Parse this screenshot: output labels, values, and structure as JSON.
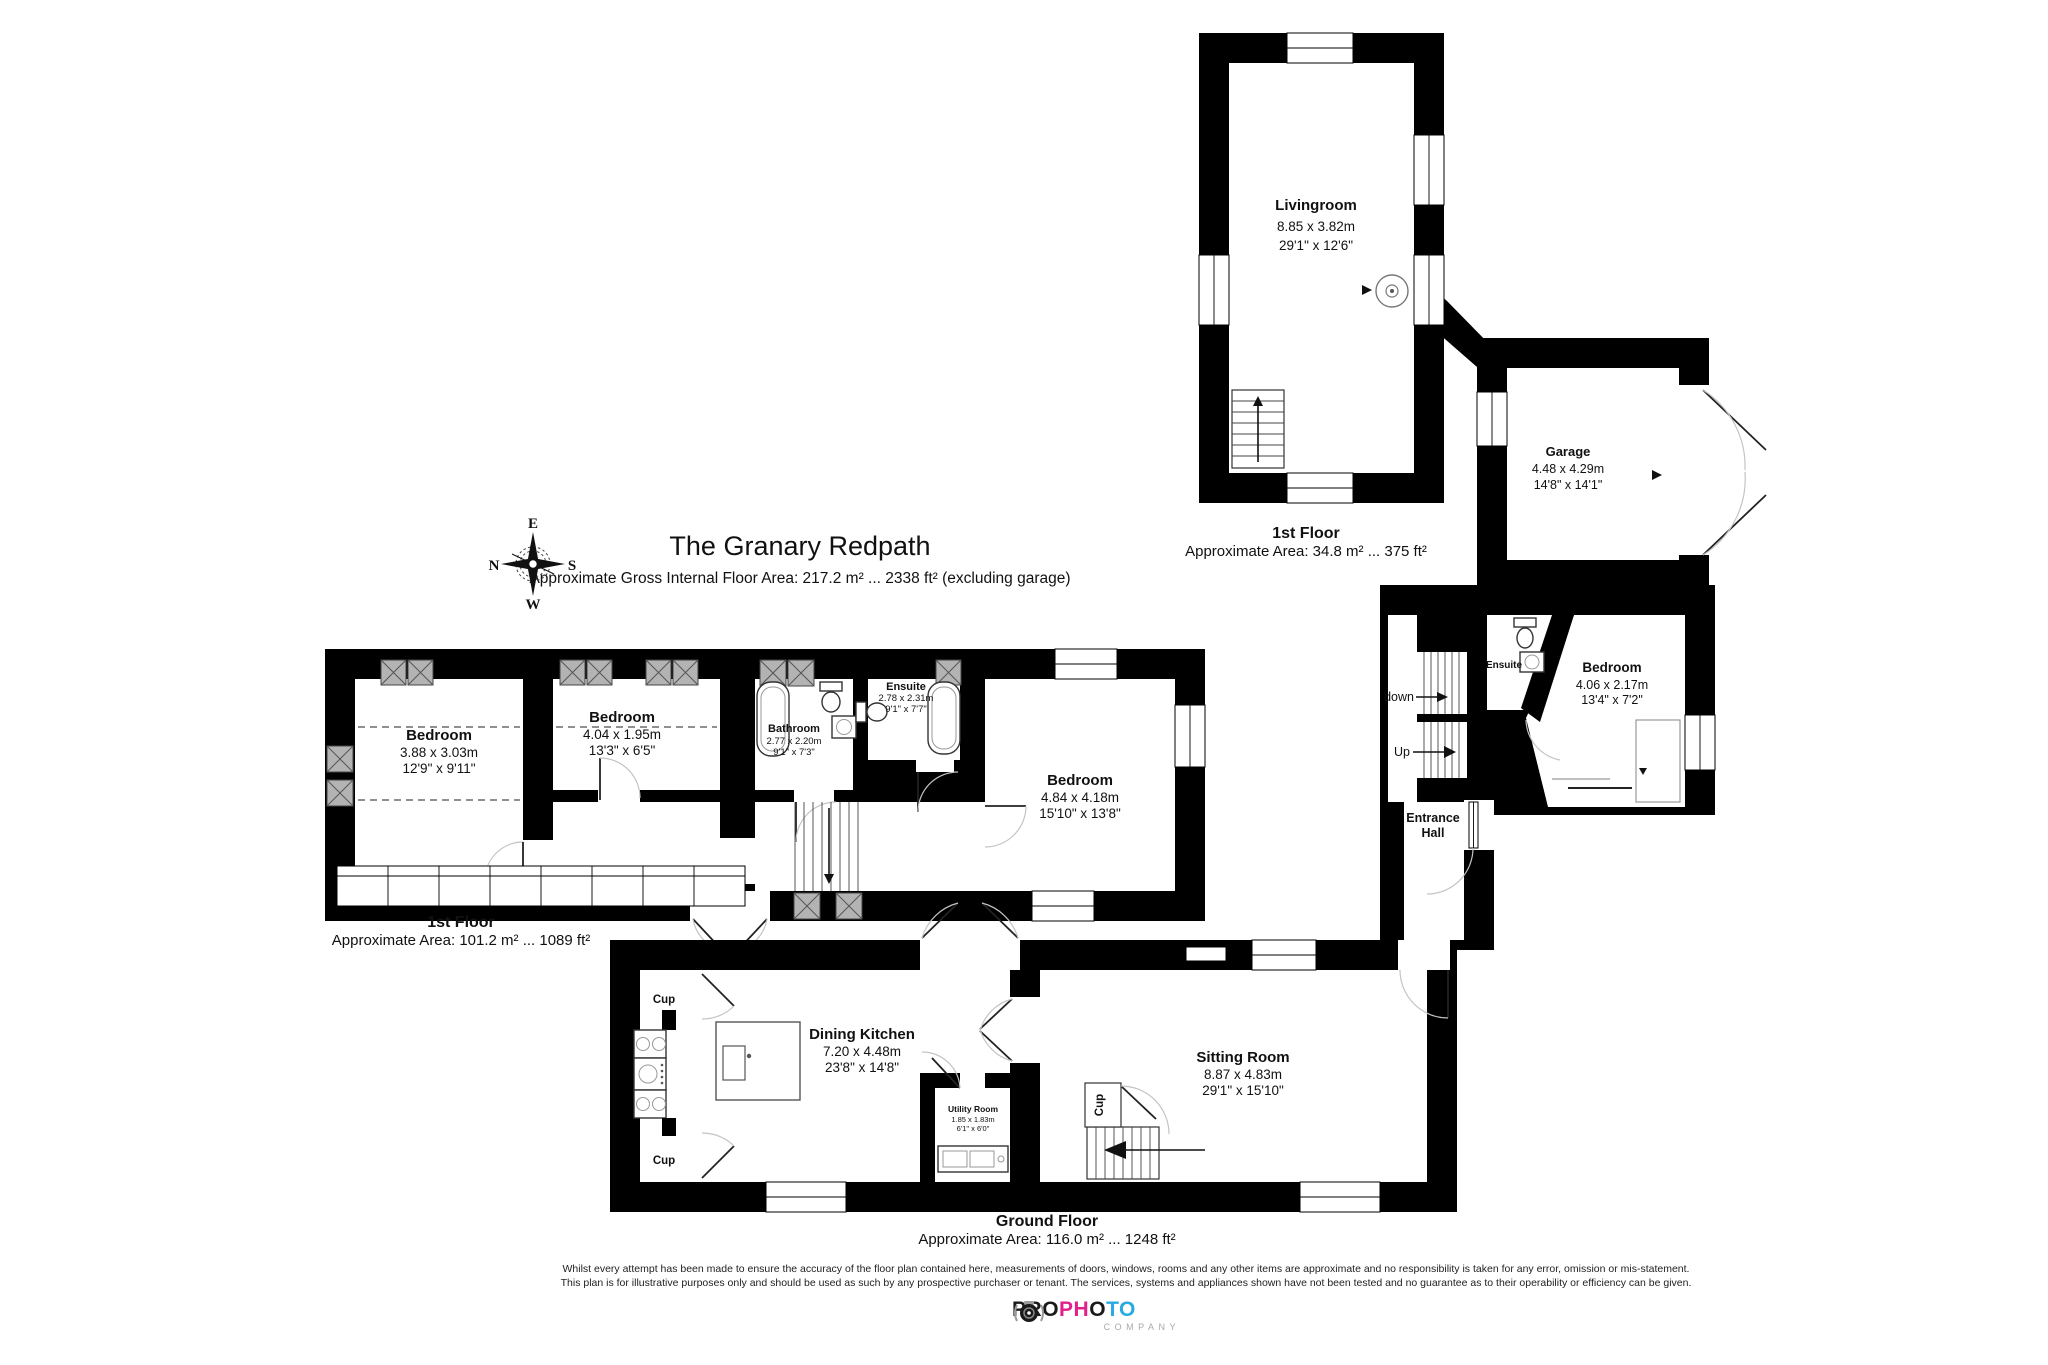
{
  "page": {
    "title": "The Granary Redpath",
    "subtitle": "Approximate Gross Internal Floor Area: 217.2 m² ... 2338 ft² (excluding garage)"
  },
  "compass": {
    "top": "E",
    "left": "N",
    "right": "S",
    "bottom": "W"
  },
  "floor_labels": {
    "annex_first": {
      "name": "1st Floor",
      "area": "Approximate Area: 34.8 m² ... 375 ft²"
    },
    "main_first": {
      "name": "1st Floor",
      "area": "Approximate Area: 101.2 m² ... 1089 ft²"
    },
    "ground": {
      "name": "Ground Floor",
      "area": "Approximate Area: 116.0 m² ... 1248 ft²"
    }
  },
  "rooms": {
    "livingroom": {
      "name": "Livingroom",
      "metric": "8.85 x 3.82m",
      "imperial": "29'1\" x 12'6\""
    },
    "garage": {
      "name": "Garage",
      "metric": "4.48 x 4.29m",
      "imperial": "14'8\" x 14'1\""
    },
    "annex_bedroom": {
      "name": "Bedroom",
      "metric": "4.06 x 2.17m",
      "imperial": "13'4\" x 7'2\""
    },
    "annex_ensuite": {
      "name": "Ensuite"
    },
    "entrance_hall": {
      "line1": "Entrance",
      "line2": "Hall"
    },
    "stairs": {
      "down": "down",
      "up": "Up"
    },
    "bedroom1": {
      "name": "Bedroom",
      "metric": "3.88 x 3.03m",
      "imperial": "12'9\" x 9'11\""
    },
    "bedroom2": {
      "name": "Bedroom",
      "metric": "4.04 x 1.95m",
      "imperial": "13'3\" x 6'5\""
    },
    "bathroom": {
      "name": "Bathroom",
      "metric": "2.77 x 2.20m",
      "imperial": "9'1\" x 7'3\""
    },
    "ensuite": {
      "name": "Ensuite",
      "metric": "2.78 x 2.31m",
      "imperial": "9'1\" x 7'7\""
    },
    "bedroom3": {
      "name": "Bedroom",
      "metric": "4.84 x 4.18m",
      "imperial": "15'10\" x 13'8\""
    },
    "dining_kitchen": {
      "name": "Dining Kitchen",
      "metric": "7.20 x 4.48m",
      "imperial": "23'8\" x 14'8\""
    },
    "utility": {
      "name": "Utility Room",
      "metric": "1.85 x 1.83m",
      "imperial": "6'1\" x 6'0\""
    },
    "sitting_room": {
      "name": "Sitting Room",
      "metric": "8.87 x 4.83m",
      "imperial": "29'1\" x 15'10\""
    },
    "cupboards": {
      "kitchen_top": "Cup",
      "kitchen_bottom": "Cup",
      "sitting": "Cup"
    }
  },
  "disclaimer": {
    "line1": "Whilst every attempt has been made to ensure the accuracy of the floor plan contained here, measurements of doors, windows, rooms and any other items are approximate and no responsibility is taken for any error, omission or mis-statement.",
    "line2": "This plan is for illustrative purposes only and should be used as such by any prospective purchaser or tenant. The services, systems and appliances shown have not been tested and no guarantee as to their operability or efficiency can be given."
  },
  "logo": {
    "letters": [
      {
        "ch": "P",
        "color": "#1a1a1a"
      },
      {
        "ch": "R",
        "color": "#1a1a1a"
      },
      {
        "ch": "O",
        "color": "#1a1a1a"
      },
      {
        "ch": "P",
        "color": "#e0218a"
      },
      {
        "ch": "H",
        "color": "#e0218a"
      },
      {
        "ch": "O",
        "color": "#1a1a1a"
      },
      {
        "ch": "T",
        "color": "#29abe2"
      },
      {
        "ch": "O",
        "color": "#29abe2"
      }
    ],
    "company": "COMPANY",
    "camera_color": "#9b9b9b"
  },
  "colors": {
    "walls": "#000000",
    "wardrobe_fill": "#b3b3b3",
    "door_arc": "#c4c4c4"
  }
}
